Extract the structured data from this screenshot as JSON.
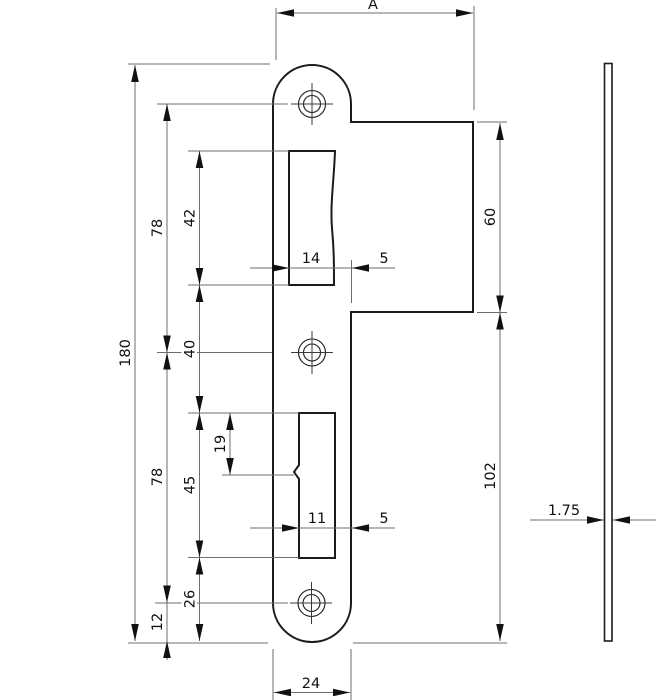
{
  "drawing": {
    "kind": "strike-plate-technical-drawing",
    "dims": {
      "a": "A",
      "total_height": "180",
      "upper_hole_pitch": "78",
      "lower_hole_pitch": "78",
      "latch_cutout_height": "42",
      "cutout_spacing": "40",
      "bolt_cutout_height": "45",
      "bolt_lip_offset": "19",
      "bolt_cutout_to_bottom": "26",
      "hole_to_bottom": "12",
      "latch_cutout_width": "14",
      "latch_cutout_edge_gap": "5",
      "bolt_cutout_width": "11",
      "bolt_cutout_edge_gap": "5",
      "tab_height": "60",
      "below_tab_height": "102",
      "plate_width": "24",
      "plate_thickness": "1.75"
    },
    "colors": {
      "outline": "#1c1c1c",
      "dimension_lines": "#6e6e6e",
      "text": "#111111",
      "background": "#ffffff"
    }
  }
}
